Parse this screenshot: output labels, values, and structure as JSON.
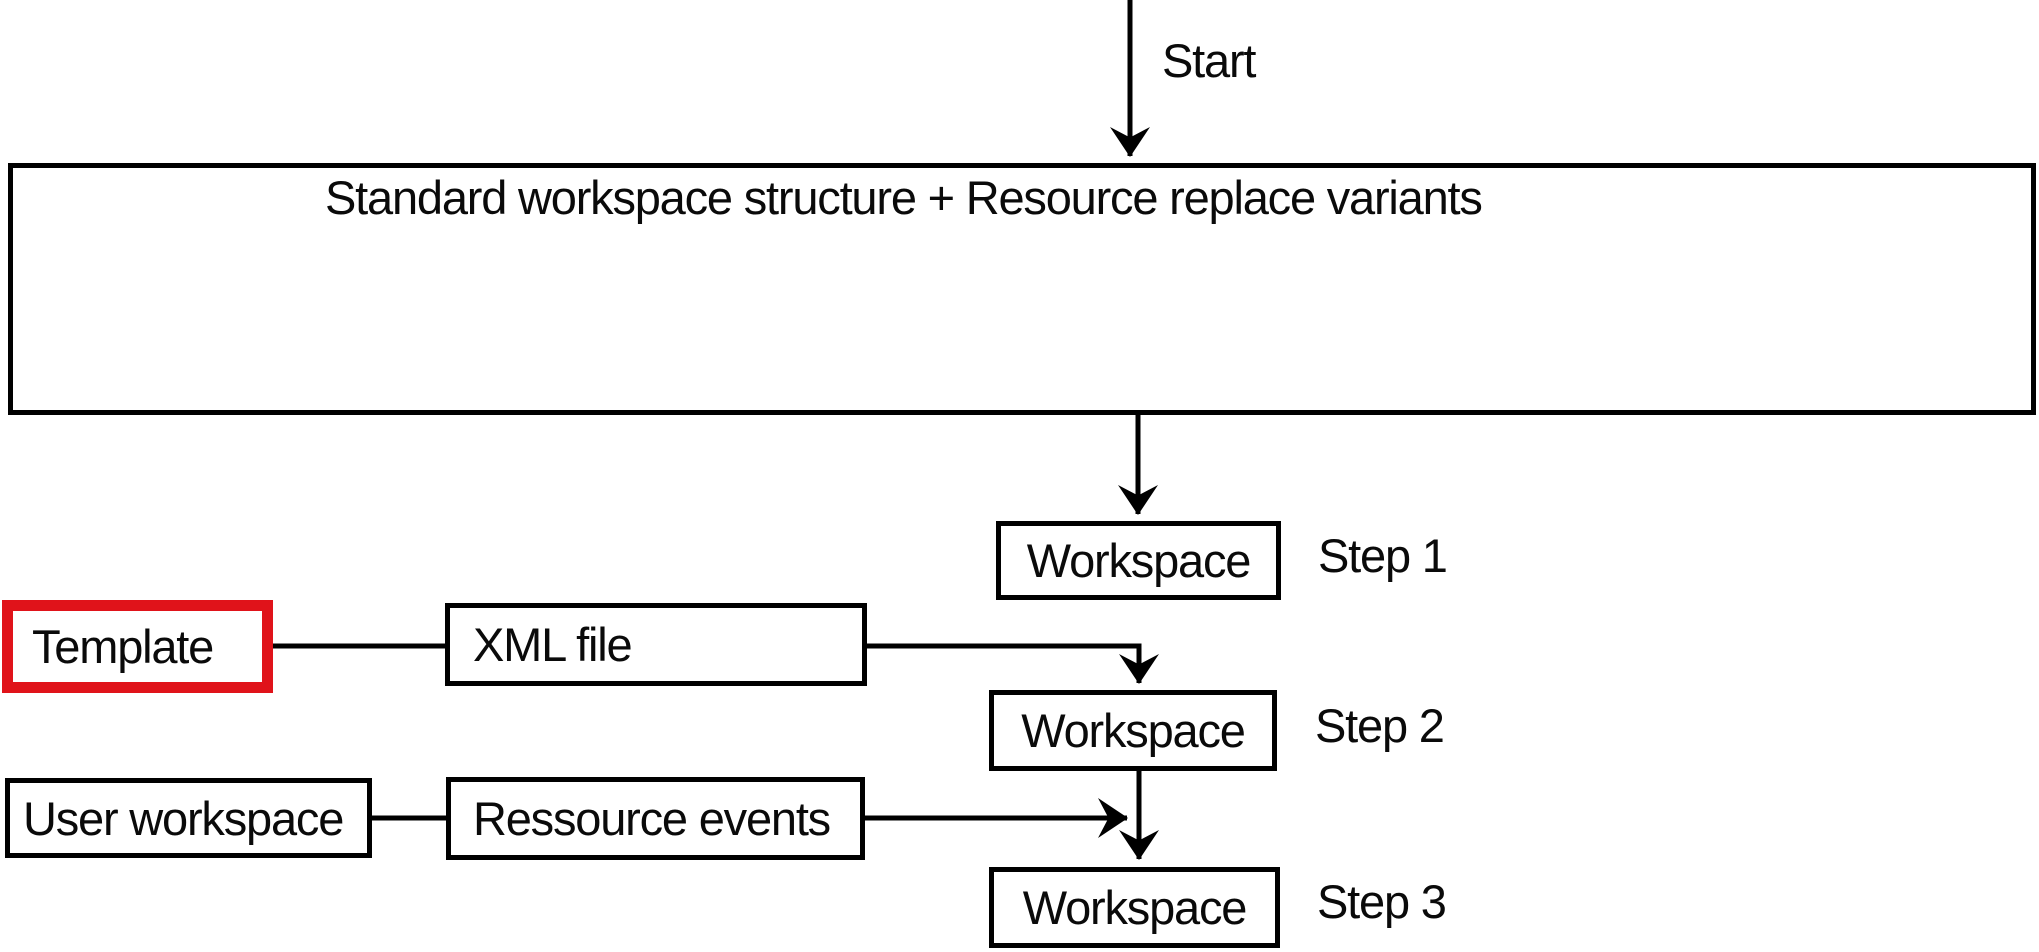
{
  "diagram": {
    "start_label": "Start",
    "main_box": {
      "label": "Standard workspace structure + Resource replace variants"
    },
    "steps": [
      {
        "box_label": "Workspace",
        "step_label": "Step 1"
      },
      {
        "box_label": "Workspace",
        "step_label": "Step 2"
      },
      {
        "box_label": "Workspace",
        "step_label": "Step 3"
      }
    ],
    "template_box": {
      "label": "Template"
    },
    "xml_box": {
      "label": "XML file"
    },
    "user_box": {
      "label": "User workspace"
    },
    "ressource_box": {
      "label": "Ressource events"
    },
    "colors": {
      "line": "#000000",
      "highlight_red": "#e0131a",
      "background": "#ffffff"
    }
  }
}
